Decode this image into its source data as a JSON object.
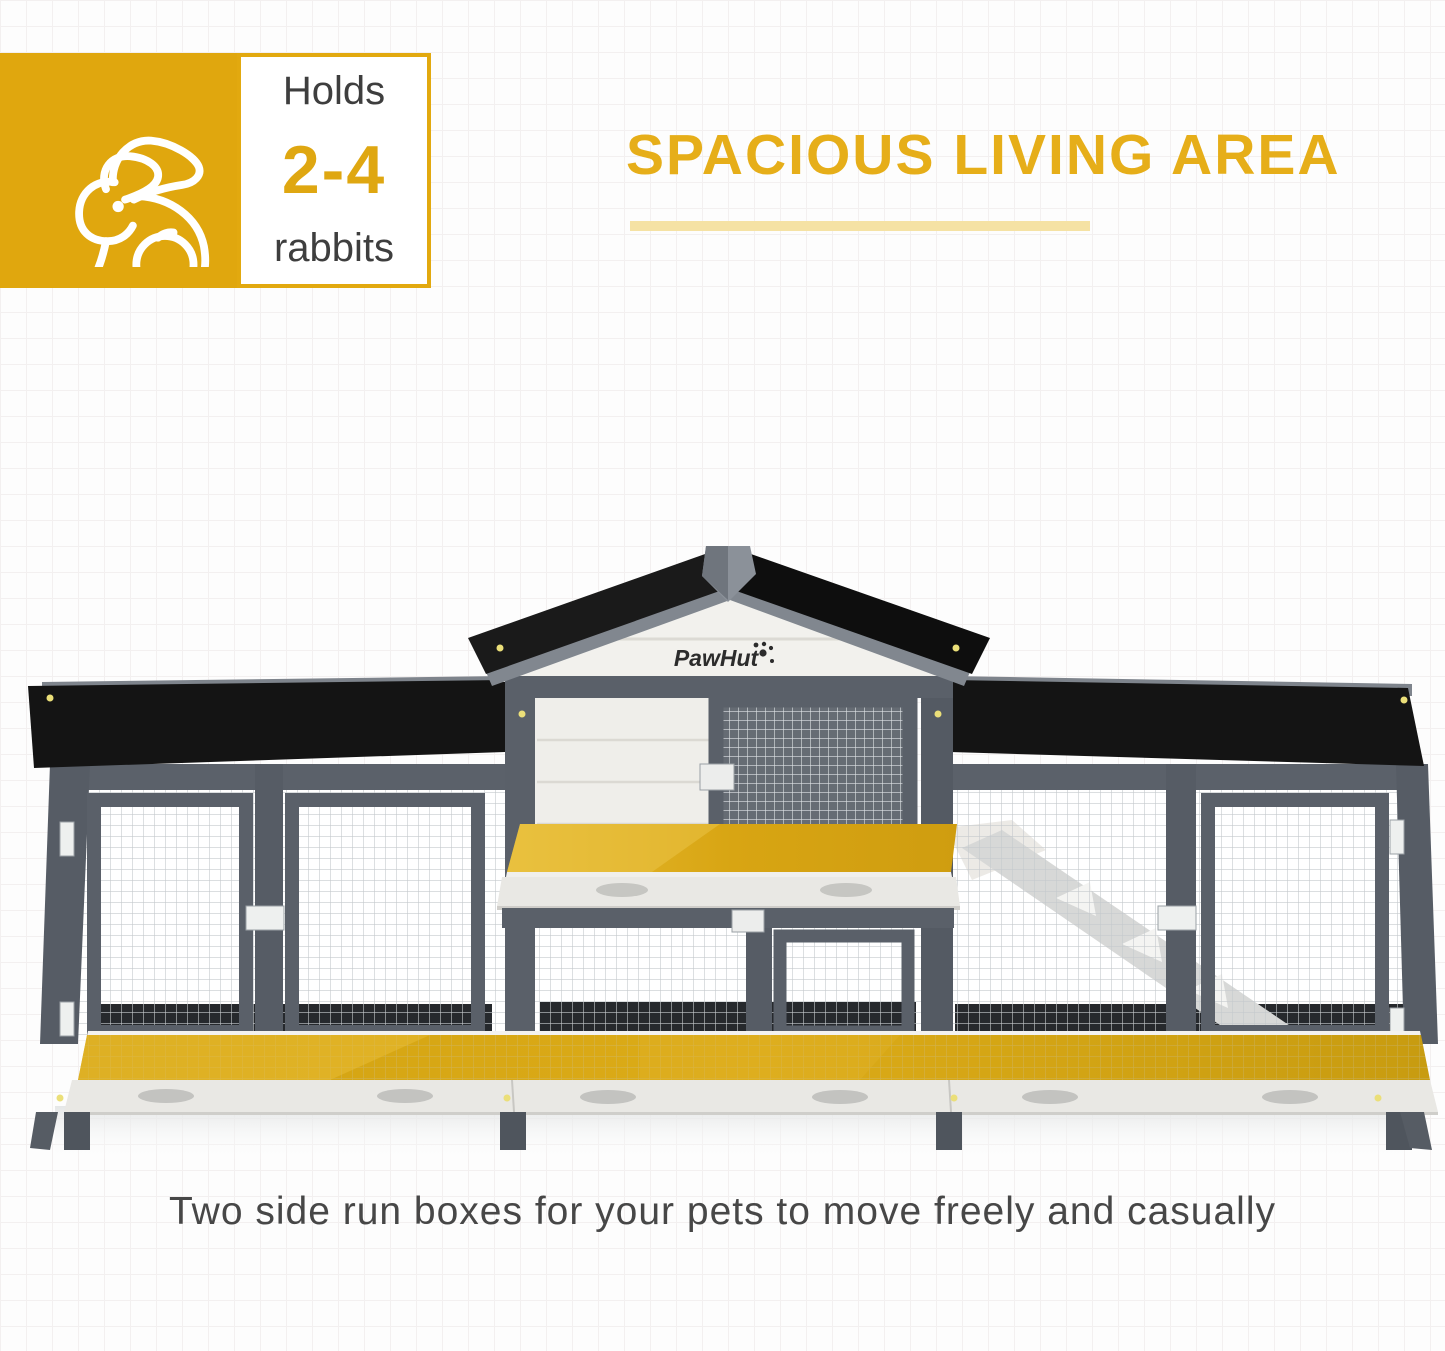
{
  "badge": {
    "icon": "rabbit-outline-icon",
    "holds_label": "Holds",
    "count": "2-4",
    "animal_label": "rabbits"
  },
  "heading": {
    "title": "SPACIOUS LIVING AREA"
  },
  "caption": {
    "text": "Two side run boxes for your pets to move freely and casually"
  },
  "product": {
    "brand": "PawHut",
    "type": "rabbit hutch with two side run boxes",
    "highlighted_areas": [
      "upper shelf platform",
      "full-width bottom run floor"
    ]
  },
  "colors": {
    "brand_yellow": "#E0A70E",
    "count_yellow": "#DFA711",
    "heading_yellow": "#E6AE19",
    "underline_yellow": "#F5E2A4",
    "highlight_yellow": "#D7A414",
    "text_dark": "#3E3E3E",
    "caption_gray": "#474747",
    "frame_gray": "#575D66",
    "roof_black": "#141414",
    "panel_white": "#F1F0EC",
    "background": "#FDFDFD",
    "grid_line": "#F3F0F0"
  }
}
